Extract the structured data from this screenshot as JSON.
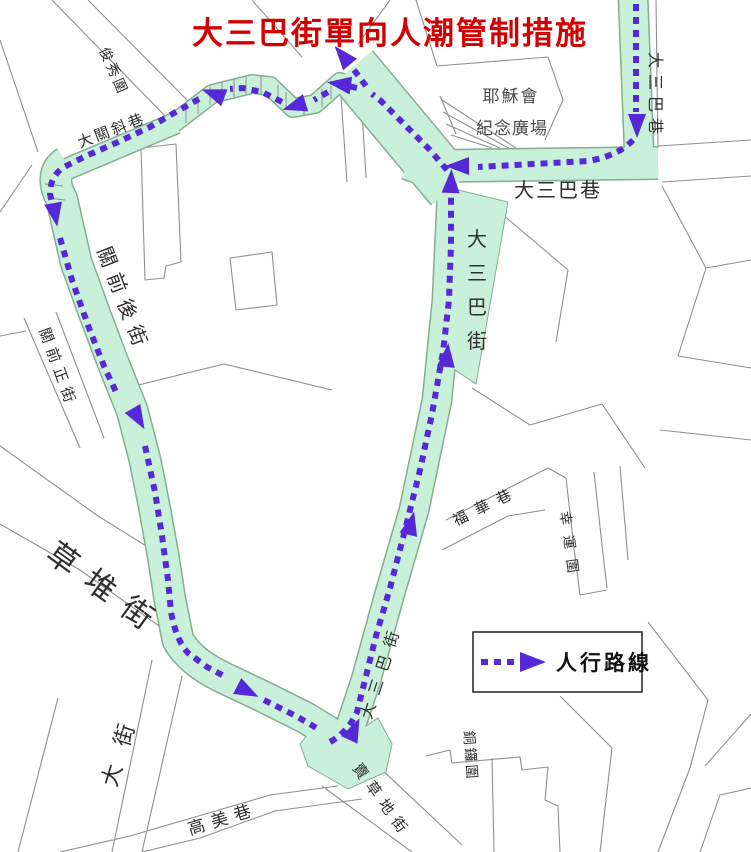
{
  "title": {
    "text": "大三巴街單向人潮管制措施"
  },
  "legend": {
    "label": "人行路線"
  },
  "plaza": {
    "line1": "耶穌會",
    "line2": "紀念廣場"
  },
  "streets": {
    "sanba_lane_top": "大三巴巷",
    "sanba_lane": "大三巴巷",
    "sanba_street_center": "大三巴街",
    "sanba_street_lower": "大三巴街",
    "guanqian_hou": "關前後街",
    "guanqian_zheng": "關前正街",
    "caodui": "草堆街",
    "da_street": "大街",
    "gaomei": "高美巷",
    "maicaodi": "賣草地街",
    "tongluo": "銅鑼圍",
    "fuhua": "福華巷",
    "xingyun": "幸運圍",
    "junxiu": "俊秀圍",
    "daguanxie": "大關斜巷"
  },
  "colors": {
    "route": "#5728d8",
    "corridor": "#c9f1da",
    "corridor_edge": "#85ad92",
    "map_line": "#8f8f8f",
    "title": "#d40000"
  }
}
